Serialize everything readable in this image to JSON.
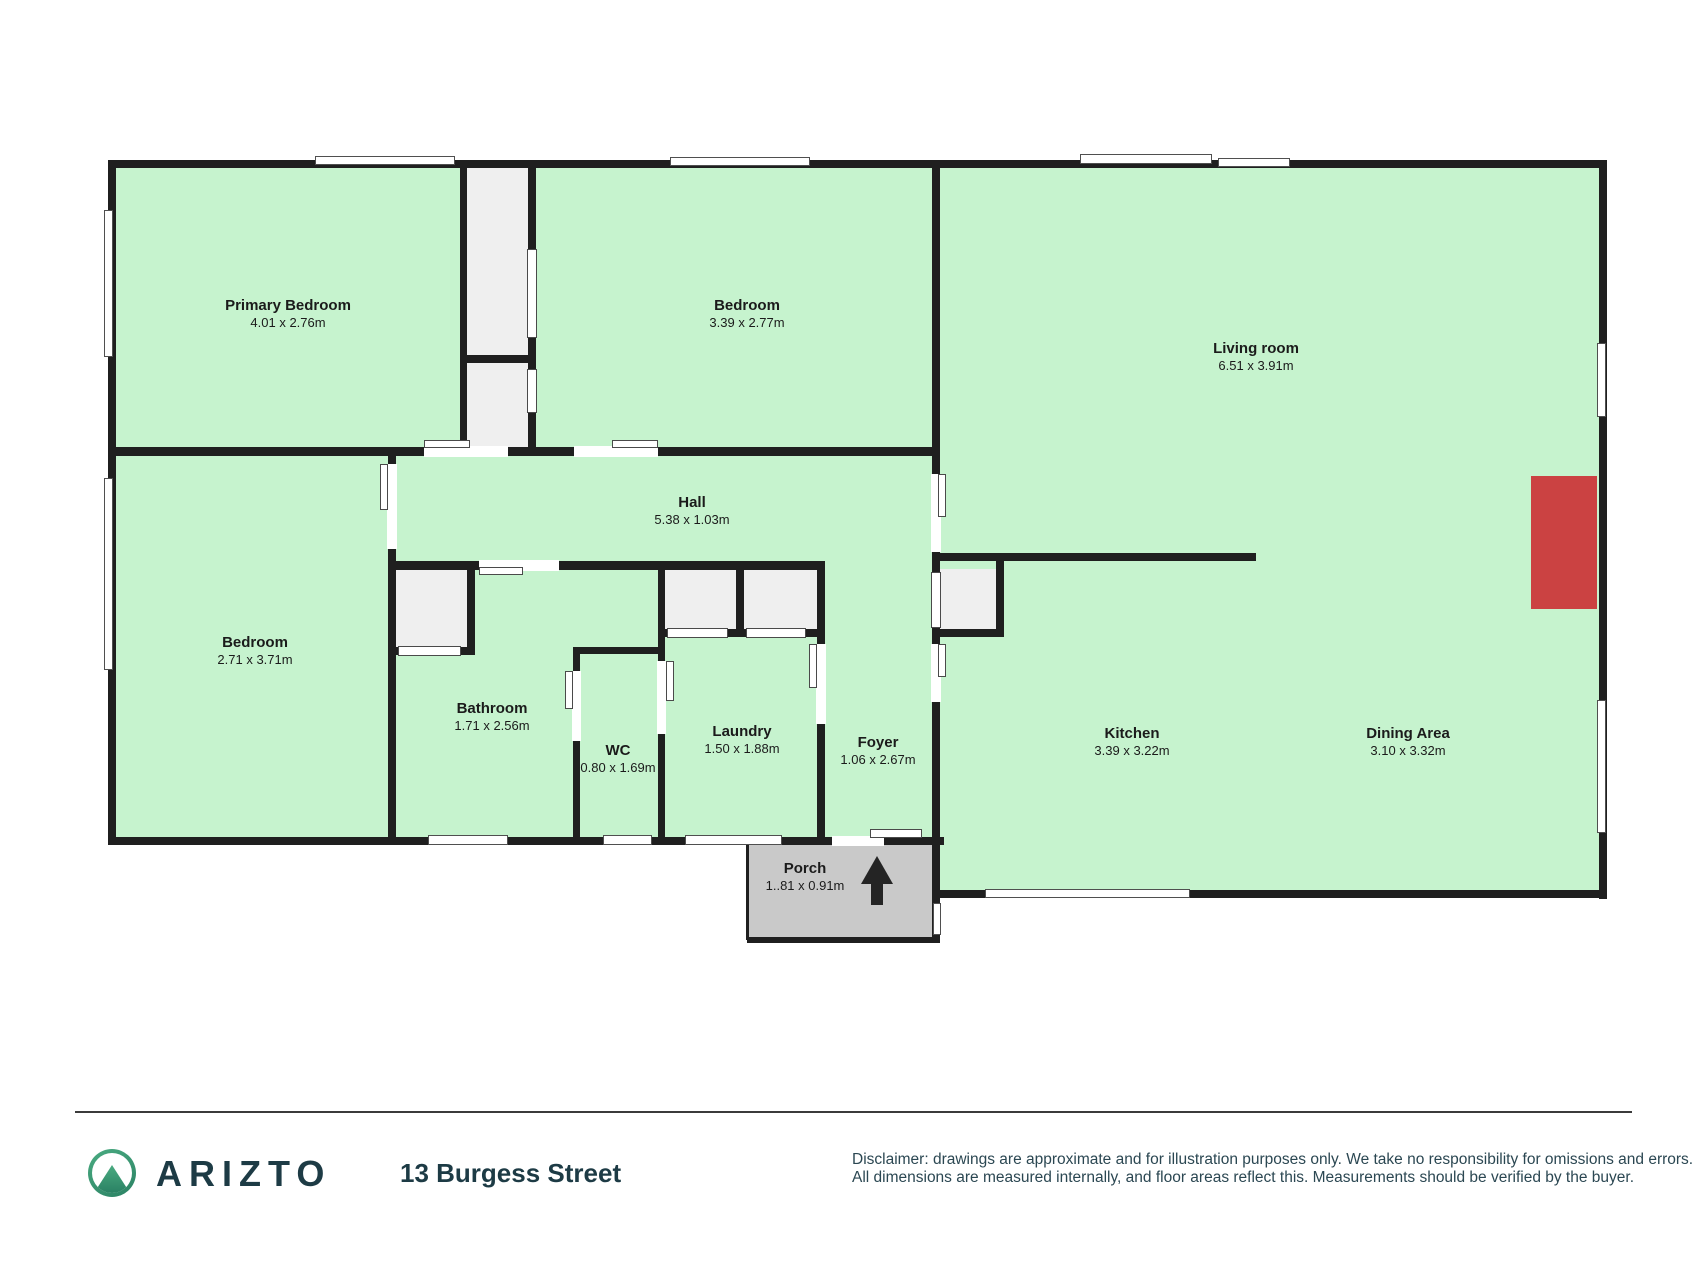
{
  "floorplan": {
    "rooms": [
      {
        "name": "Primary Bedroom",
        "dims": "4.01 x 2.76m"
      },
      {
        "name": "Bedroom",
        "dims": "3.39 x 2.77m"
      },
      {
        "name": "Living room",
        "dims": "6.51 x 3.91m"
      },
      {
        "name": "Bedroom",
        "dims": "2.71 x 3.71m"
      },
      {
        "name": "Hall",
        "dims": "5.38 x 1.03m"
      },
      {
        "name": "Bathroom",
        "dims": "1.71 x 2.56m"
      },
      {
        "name": "WC",
        "dims": "0.80 x 1.69m"
      },
      {
        "name": "Laundry",
        "dims": "1.50 x 1.88m"
      },
      {
        "name": "Foyer",
        "dims": "1.06 x 2.67m"
      },
      {
        "name": "Kitchen",
        "dims": "3.39 x 3.22m"
      },
      {
        "name": "Dining Area",
        "dims": "3.10 x 3.32m"
      },
      {
        "name": "Porch",
        "dims": "1..81 x 0.91m"
      }
    ],
    "colors": {
      "room_fill": "#c6f3ce",
      "wall": "#1f1f1f",
      "closet_fill": "#efefef",
      "porch_fill": "#c9c9c9",
      "feature_red": "#cb4242",
      "brand_teal": "#1d3b45",
      "logo_green_light": "#4aab81",
      "logo_green_dark": "#2a8163"
    }
  },
  "footer": {
    "brand": "ARIZTO",
    "address": "13 Burgess Street",
    "disclaimer_line1": "Disclaimer: drawings are approximate and for illustration purposes only. We take no responsibility for omissions and errors.",
    "disclaimer_line2": "All dimensions are measured internally, and floor areas reflect this. Measurements should be verified by the buyer."
  }
}
